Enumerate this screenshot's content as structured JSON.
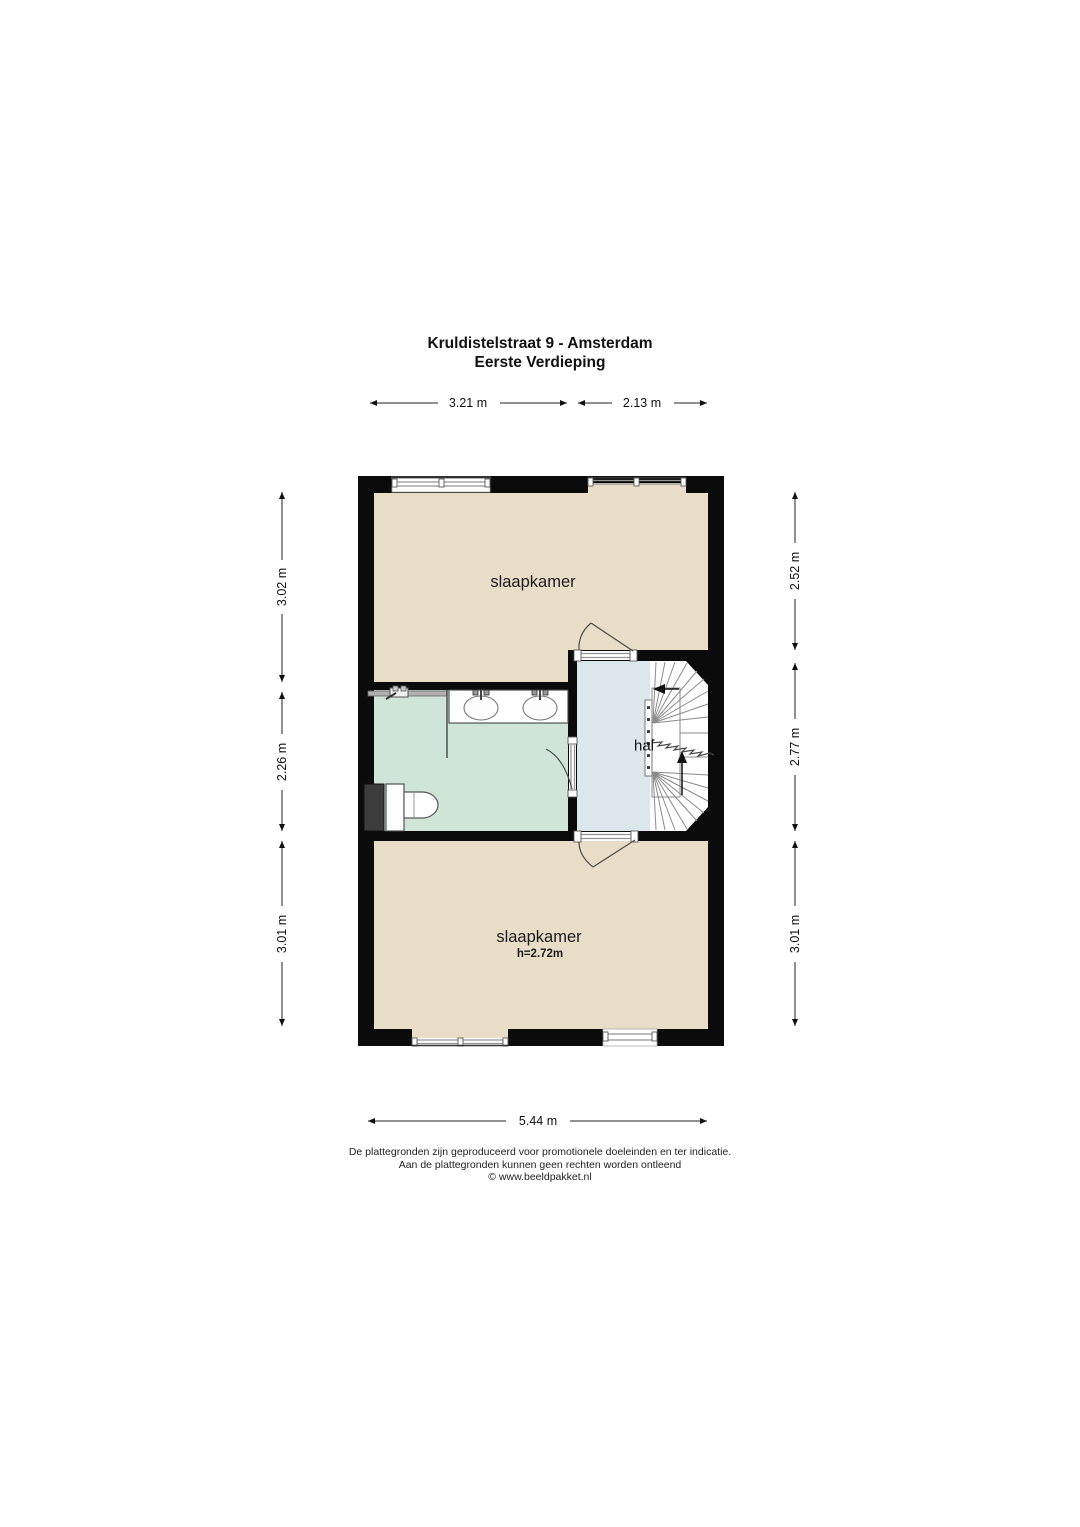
{
  "title": {
    "line1": "Kruldistelstraat 9 - Amsterdam",
    "line2": "Eerste Verdieping"
  },
  "rooms": {
    "bedroom_top_label": "slaapkamer",
    "bedroom_bottom_label": "slaapkamer",
    "bedroom_bottom_height": "h=2.72m",
    "hall_label": "hal"
  },
  "dimensions": {
    "top": [
      "3.21 m",
      "2.13 m"
    ],
    "left": [
      "3.02 m",
      "2.26 m",
      "3.01 m"
    ],
    "right": [
      "2.52 m",
      "2.77 m",
      "3.01 m"
    ],
    "bottom": "5.44 m"
  },
  "footer": {
    "line1": "De plattegronden zijn geproduceerd voor promotionele doeleinden en ter indicatie.",
    "line2": "Aan de plattegronden kunnen geen rechten worden ontleend",
    "line3": "© www.beeldpakket.nl"
  },
  "colors": {
    "wall": "#0b0b0b",
    "floor_bedroom": "#e8dec7",
    "floor_bathroom": "#cfe5d7",
    "floor_hall": "#dbe7ea",
    "duct": "#3c3c3c"
  }
}
